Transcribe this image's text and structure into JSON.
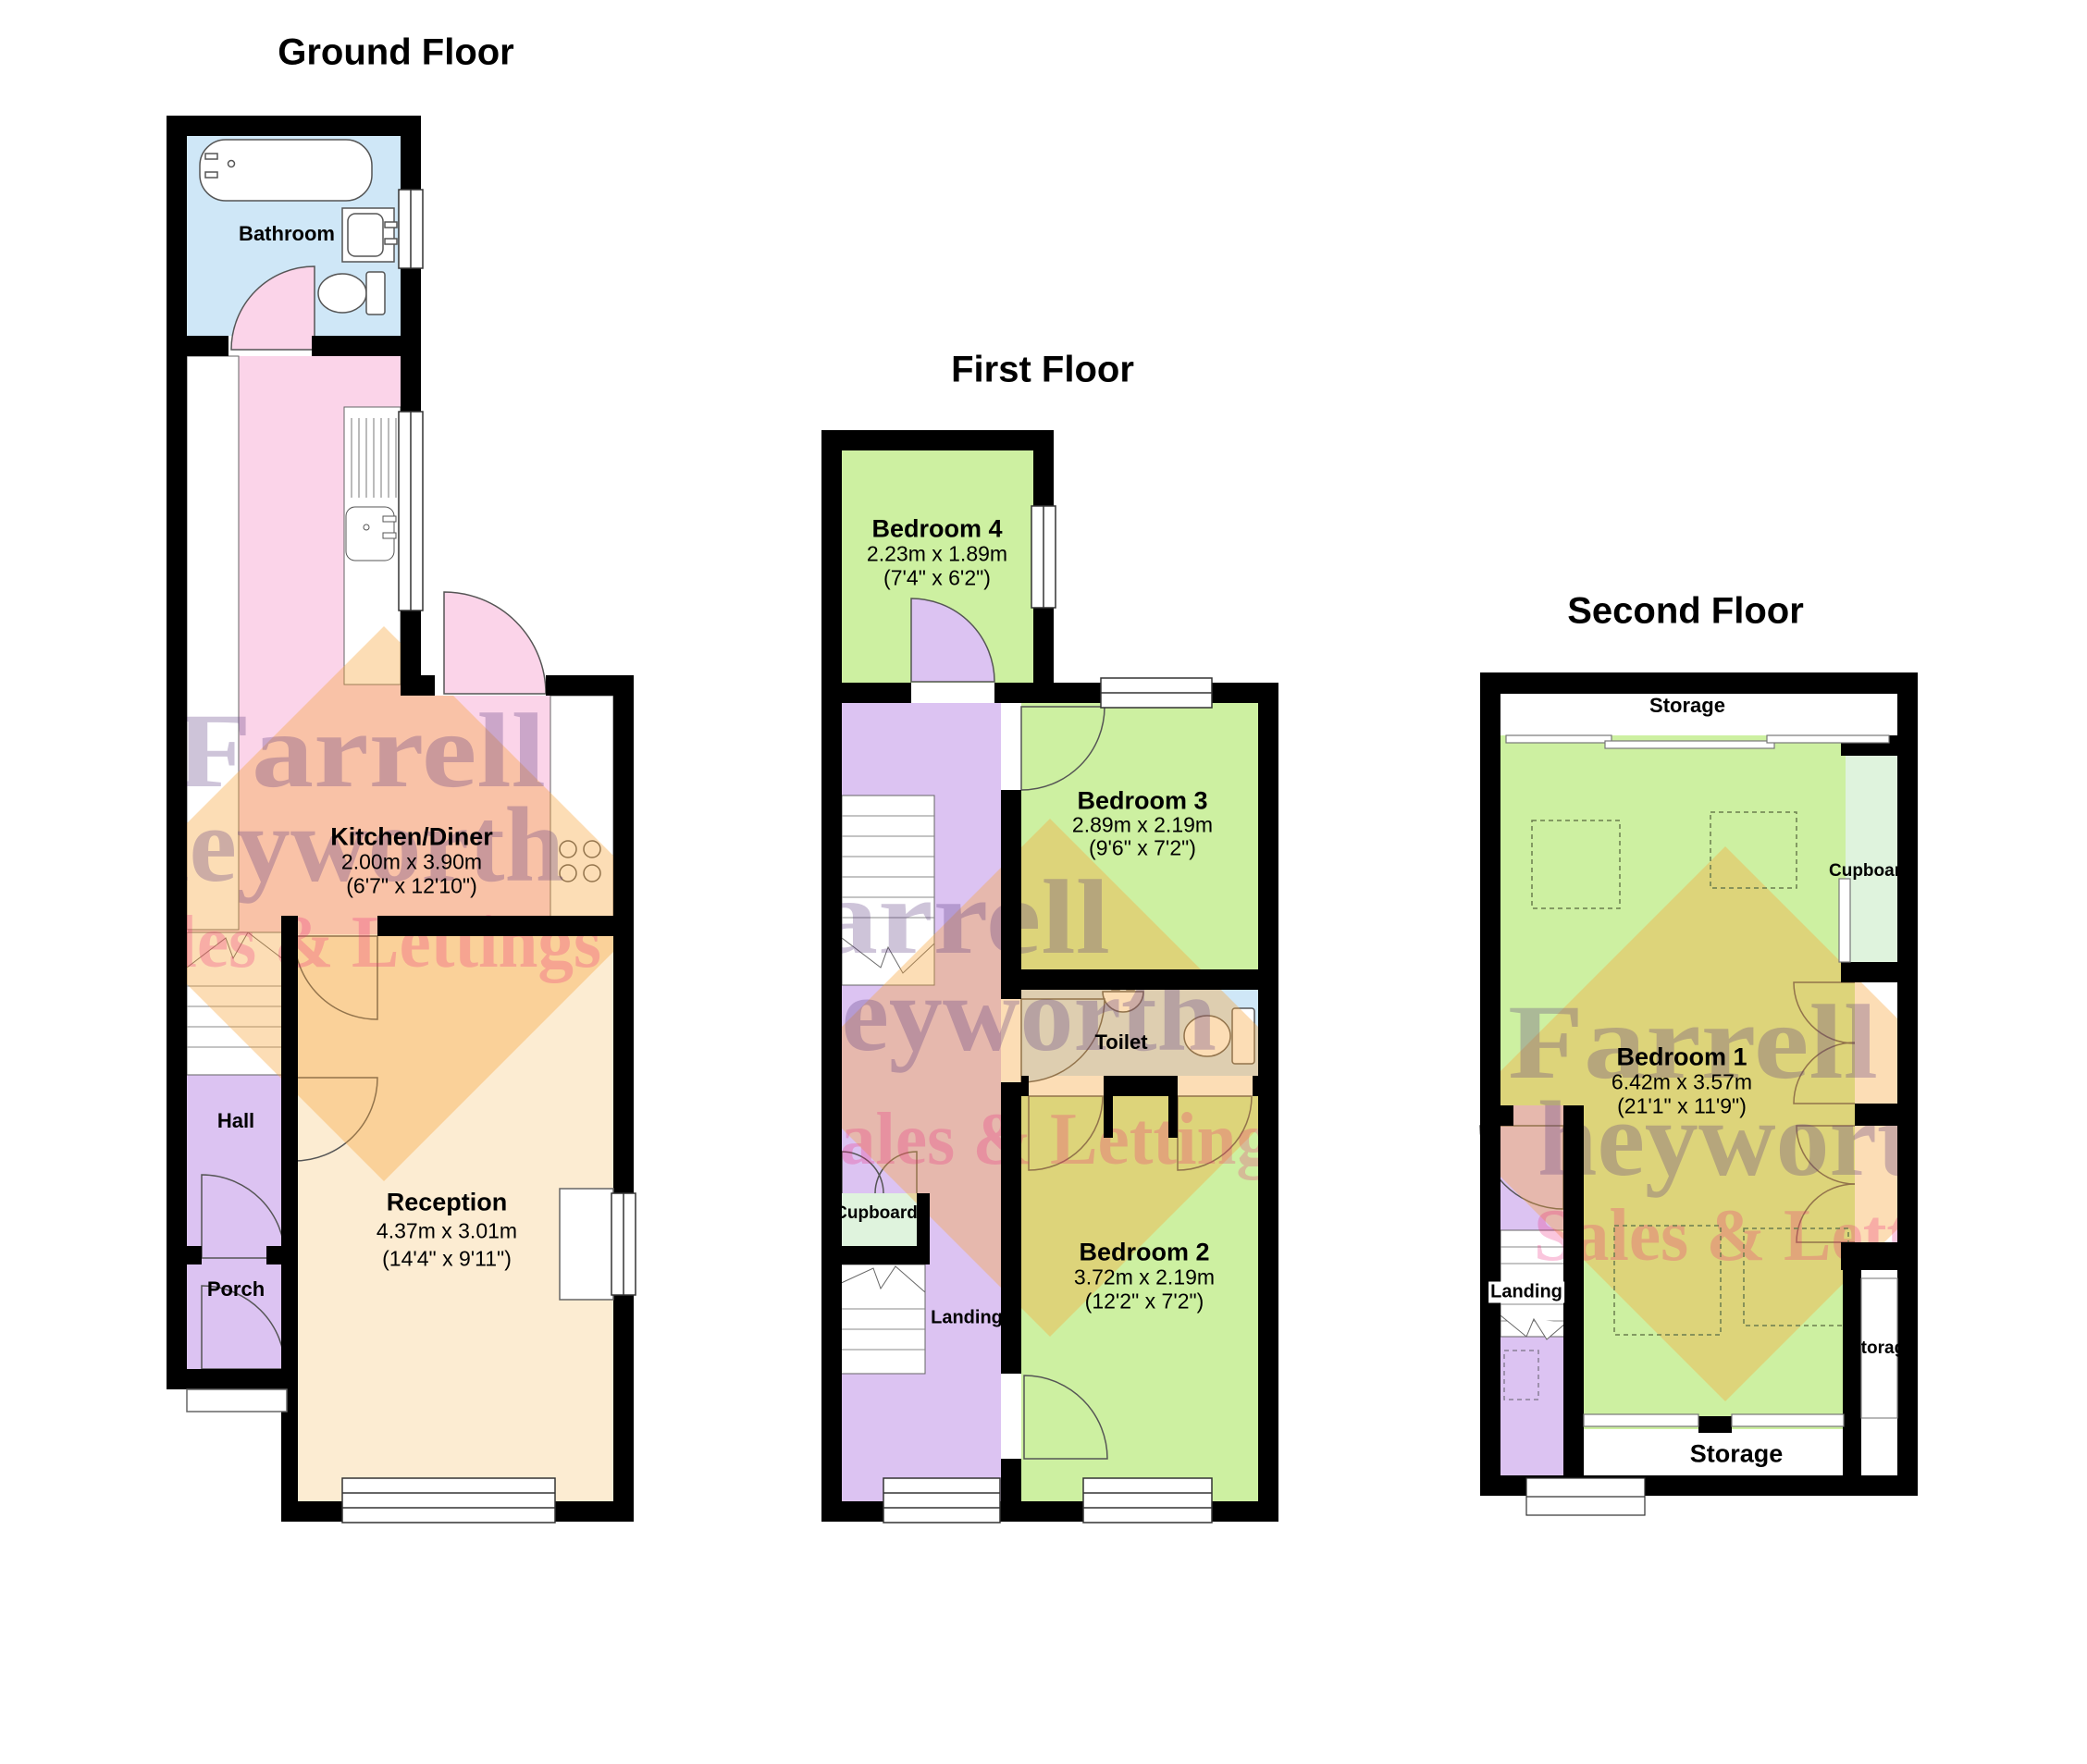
{
  "floors": {
    "ground": {
      "title": "Ground Floor",
      "rooms": {
        "bathroom": {
          "label": "Bathroom"
        },
        "kitchen": {
          "name": "Kitchen/Diner",
          "dims_m": "2.00m x 3.90m",
          "dims_ft": "(6'7\" x 12'10\")"
        },
        "reception": {
          "name": "Reception",
          "dims_m": "4.37m x 3.01m",
          "dims_ft": "(14'4\" x 9'11\")"
        },
        "hall": {
          "label": "Hall"
        },
        "porch": {
          "label": "Porch"
        }
      }
    },
    "first": {
      "title": "First Floor",
      "rooms": {
        "bedroom4": {
          "name": "Bedroom 4",
          "dims_m": "2.23m x 1.89m",
          "dims_ft": "(7'4\" x 6'2\")"
        },
        "bedroom3": {
          "name": "Bedroom 3",
          "dims_m": "2.89m x 2.19m",
          "dims_ft": "(9'6\" x 7'2\")"
        },
        "toilet": {
          "label": "Toilet"
        },
        "bedroom2": {
          "name": "Bedroom 2",
          "dims_m": "3.72m x 2.19m",
          "dims_ft": "(12'2\" x 7'2\")"
        },
        "cupboard": {
          "label": "Cupboard"
        },
        "landing": {
          "label": "Landing"
        }
      }
    },
    "second": {
      "title": "Second Floor",
      "rooms": {
        "storage_top": {
          "label": "Storage"
        },
        "cupboard": {
          "label": "Cupboard"
        },
        "bedroom1": {
          "name": "Bedroom 1",
          "dims_m": "6.42m x 3.57m",
          "dims_ft": "(21'1\" x 11'9\")"
        },
        "landing": {
          "label": "Landing"
        },
        "storage_right": {
          "label": "Storage"
        },
        "storage_bottom": {
          "label": "Storage"
        }
      }
    }
  },
  "watermark": {
    "line1": "Farrell",
    "line2": "heyworth",
    "line3": "Sales & Lettings"
  },
  "colors": {
    "wall": "#000000",
    "bedroom_green": "#cdf0a1",
    "cupboard_mint": "#dff3dd",
    "bathroom_blue": "#cfe7f7",
    "kitchen_pink": "#fbd4e9",
    "reception_cream": "#fcecd2",
    "hall_purple": "#dcc3f2"
  }
}
